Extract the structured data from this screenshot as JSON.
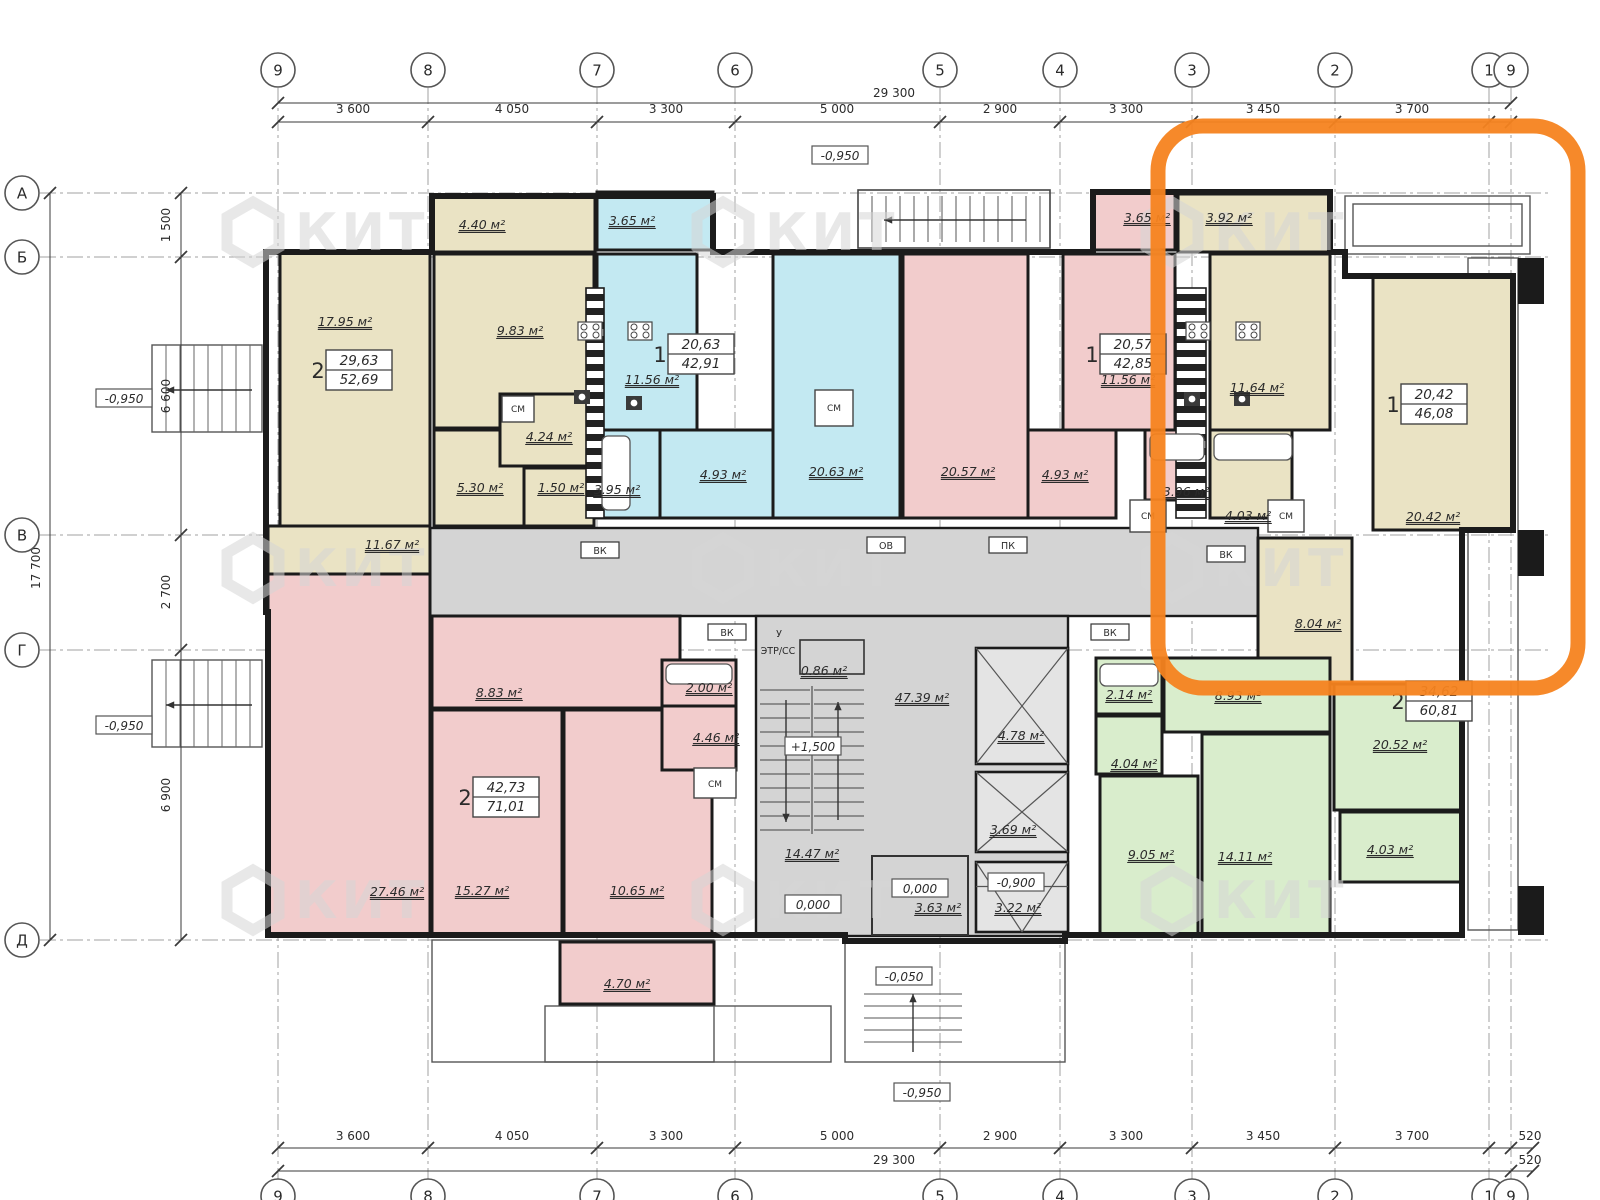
{
  "drawing": {
    "kind": "apartment-floor-plan",
    "watermark_text": "КИТ"
  },
  "colors": {
    "beige": "#EAE3C4",
    "cyan": "#C3E9F2",
    "pink": "#F2CCCC",
    "green": "#D9EDCC",
    "gray": "#D4D4D4",
    "lift": "#E4E4E4",
    "wall": "#1B1B1B",
    "dim": "#3A3A3A",
    "axis": "#A0A0A0",
    "orange": "#F5831F",
    "watermark": "#D6D6D6"
  },
  "highlight": {
    "x": 1158,
    "y": 126,
    "w": 420,
    "h": 562,
    "radius": 45,
    "stroke_width": 15
  },
  "watermark_positions": [
    [
      253,
      232
    ],
    [
      723,
      232
    ],
    [
      1172,
      232
    ],
    [
      253,
      568
    ],
    [
      723,
      568
    ],
    [
      1172,
      568
    ],
    [
      253,
      900
    ],
    [
      723,
      900
    ],
    [
      1172,
      900
    ]
  ],
  "axes": {
    "top_y": 70,
    "bottom_y": 1196,
    "left_x": 22,
    "vertical": [
      [
        "9",
        278
      ],
      [
        "8",
        428
      ],
      [
        "7",
        597
      ],
      [
        "6",
        735
      ],
      [
        "5",
        940
      ],
      [
        "4",
        1060
      ],
      [
        "3",
        1192
      ],
      [
        "2",
        1335
      ],
      [
        "1",
        1489
      ],
      [
        "9",
        1511
      ]
    ],
    "horizontal": [
      [
        "А",
        193
      ],
      [
        "Б",
        257
      ],
      [
        "В",
        535
      ],
      [
        "Г",
        650
      ],
      [
        "Д",
        940
      ]
    ]
  },
  "dimensions": {
    "top_total": {
      "text": "29 300",
      "x": 894,
      "y": 97,
      "line_y": 103
    },
    "top_segments": {
      "label_y": 113,
      "line_y": 122,
      "items": [
        [
          "3 600",
          353
        ],
        [
          "4 050",
          512
        ],
        [
          "3 300",
          666
        ],
        [
          "5 000",
          837
        ],
        [
          "2 900",
          1000
        ],
        [
          "3 300",
          1126
        ],
        [
          "3 450",
          1263
        ],
        [
          "3 700",
          1412
        ]
      ]
    },
    "bottom_segments": {
      "label_y": 1140,
      "line_y": 1148,
      "items": [
        [
          "3 600",
          353
        ],
        [
          "4 050",
          512
        ],
        [
          "3 300",
          666
        ],
        [
          "5 000",
          837
        ],
        [
          "2 900",
          1000
        ],
        [
          "3 300",
          1126
        ],
        [
          "3 450",
          1263
        ],
        [
          "3 700",
          1412
        ],
        [
          "520",
          1530
        ]
      ]
    },
    "bottom_total": {
      "text": "29 300",
      "x": 894,
      "y": 1164,
      "line_y": 1171,
      "extra_text": "520",
      "extra_x": 1530
    },
    "left_segments": {
      "label_x": 170,
      "line_x": 181,
      "items": [
        [
          "1 500",
          225
        ],
        [
          "6 600",
          396
        ],
        [
          "2 700",
          592
        ],
        [
          "6 900",
          795
        ]
      ]
    },
    "left_total": {
      "text": "17 700",
      "x": 40,
      "y": 568,
      "line_x": 50
    }
  },
  "apartments": [
    {
      "rooms_count": "2",
      "area_living": "29,63",
      "area_total": "52,69",
      "x": 348,
      "y": 370
    },
    {
      "rooms_count": "1",
      "area_living": "20,63",
      "area_total": "42,91",
      "x": 690,
      "y": 354
    },
    {
      "rooms_count": "1",
      "area_living": "20,57",
      "area_total": "42,85",
      "x": 1122,
      "y": 354
    },
    {
      "rooms_count": "1",
      "area_living": "20,42",
      "area_total": "46,08",
      "x": 1423,
      "y": 404
    },
    {
      "rooms_count": "2",
      "area_living": "42,73",
      "area_total": "71,01",
      "x": 495,
      "y": 797
    },
    {
      "rooms_count": "2",
      "area_living": "34,62",
      "area_total": "60,81",
      "x": 1428,
      "y": 701
    }
  ],
  "rooms": [
    {
      "name": "balcony",
      "area": "4.40 м²",
      "f": "beige",
      "r": [
        432,
        196,
        163,
        56
      ],
      "lx": 482,
      "ly": 229
    },
    {
      "name": "living",
      "area": "17.95 м²",
      "f": "beige",
      "r": [
        280,
        252,
        150,
        274
      ],
      "lx": 345,
      "ly": 326
    },
    {
      "name": "living",
      "area": "11.67 м²",
      "f": "beige",
      "r": [
        268,
        526,
        162,
        88
      ],
      "lx": 392,
      "ly": 549
    },
    {
      "name": "kitchen",
      "area": "9.83 м²",
      "f": "beige",
      "r": [
        434,
        254,
        160,
        174
      ],
      "lx": 520,
      "ly": 335
    },
    {
      "name": "hall",
      "area": "5.30 м²",
      "f": "beige",
      "r": [
        434,
        430,
        126,
        96
      ],
      "lx": 480,
      "ly": 492
    },
    {
      "name": "wc",
      "area": "4.24 м²",
      "f": "beige",
      "r": [
        500,
        394,
        94,
        72
      ],
      "lx": 549,
      "ly": 441
    },
    {
      "name": "wc",
      "area": "1.50 м²",
      "f": "beige",
      "r": [
        524,
        468,
        70,
        58
      ],
      "lx": 561,
      "ly": 492
    },
    {
      "name": "balcony",
      "area": "3.65 м²",
      "f": "cyan",
      "r": [
        597,
        192,
        116,
        58
      ],
      "lx": 632,
      "ly": 225
    },
    {
      "name": "kitchen",
      "area": "11.56 м²",
      "f": "cyan",
      "r": [
        597,
        254,
        100,
        176
      ],
      "lx": 652,
      "ly": 384
    },
    {
      "name": "living",
      "area": "20.63 м²",
      "f": "cyan",
      "r": [
        773,
        254,
        127,
        264
      ],
      "lx": 836,
      "ly": 476
    },
    {
      "name": "hall",
      "area": "4.93 м²",
      "f": "cyan",
      "r": [
        660,
        430,
        113,
        88
      ],
      "lx": 723,
      "ly": 479
    },
    {
      "name": "bath",
      "area": "3.95 м²",
      "f": "cyan",
      "r": [
        597,
        430,
        63,
        88
      ],
      "lx": 617,
      "ly": 494
    },
    {
      "name": "balcony",
      "area": "3.65 м²",
      "f": "pink",
      "r": [
        1093,
        192,
        82,
        58
      ],
      "lx": 1147,
      "ly": 222
    },
    {
      "name": "living",
      "area": "20.57 м²",
      "f": "pink",
      "r": [
        903,
        254,
        125,
        264
      ],
      "lx": 968,
      "ly": 476
    },
    {
      "name": "kitchen",
      "area": "11.56 м²",
      "f": "pink",
      "r": [
        1063,
        254,
        112,
        176
      ],
      "lx": 1128,
      "ly": 384
    },
    {
      "name": "hall",
      "area": "4.93 м²",
      "f": "pink",
      "r": [
        1028,
        430,
        88,
        88
      ],
      "lx": 1065,
      "ly": 479
    },
    {
      "name": "bath",
      "area": "3.96 м²",
      "f": "pink",
      "r": [
        1145,
        430,
        60,
        70
      ],
      "lx": 1186,
      "ly": 496
    },
    {
      "name": "balcony",
      "area": "3.92 м²",
      "f": "beige",
      "r": [
        1178,
        194,
        152,
        58
      ],
      "lx": 1229,
      "ly": 222
    },
    {
      "name": "kitchen",
      "area": "11.64 м²",
      "f": "beige",
      "r": [
        1210,
        254,
        120,
        176
      ],
      "lx": 1257,
      "ly": 392
    },
    {
      "name": "living",
      "area": "20.42 м²",
      "f": "beige",
      "r": [
        1373,
        276,
        140,
        254
      ],
      "lx": 1433,
      "ly": 521
    },
    {
      "name": "bath",
      "area": "4.03 м²",
      "f": "beige",
      "r": [
        1210,
        430,
        82,
        88
      ],
      "lx": 1248,
      "ly": 520
    },
    {
      "name": "hall",
      "area": "8.04 м²",
      "f": "beige",
      "r": [
        1258,
        538,
        94,
        146
      ],
      "lx": 1318,
      "ly": 628
    },
    {
      "name": "bath",
      "area": "2.14 м²",
      "f": "green",
      "r": [
        1096,
        658,
        66,
        56
      ],
      "lx": 1129,
      "ly": 699
    },
    {
      "name": "hall",
      "area": "8.93 м²",
      "f": "green",
      "r": [
        1164,
        658,
        166,
        74
      ],
      "lx": 1238,
      "ly": 700
    },
    {
      "name": "wc",
      "area": "4.04 м²",
      "f": "green",
      "r": [
        1096,
        716,
        66,
        58
      ],
      "lx": 1134,
      "ly": 768
    },
    {
      "name": "living",
      "area": "9.05 м²",
      "f": "green",
      "r": [
        1100,
        776,
        98,
        160
      ],
      "lx": 1151,
      "ly": 859
    },
    {
      "name": "living",
      "area": "14.11 м²",
      "f": "green",
      "r": [
        1202,
        734,
        128,
        202
      ],
      "lx": 1245,
      "ly": 861
    },
    {
      "name": "living",
      "area": "20.52 м²",
      "f": "green",
      "r": [
        1334,
        684,
        128,
        126
      ],
      "lx": 1400,
      "ly": 749
    },
    {
      "name": "balcony",
      "area": "4.03 м²",
      "f": "green",
      "r": [
        1340,
        812,
        122,
        70
      ],
      "lx": 1390,
      "ly": 854
    },
    {
      "name": "living",
      "area": "27.46 м²",
      "f": "pink",
      "r": [
        268,
        574,
        162,
        361
      ],
      "lx": 397,
      "ly": 896
    },
    {
      "name": "hall",
      "area": "8.83 м²",
      "f": "pink",
      "r": [
        432,
        616,
        248,
        92
      ],
      "lx": 499,
      "ly": 697
    },
    {
      "name": "living",
      "area": "15.27 м²",
      "f": "pink",
      "r": [
        432,
        710,
        130,
        226
      ],
      "lx": 482,
      "ly": 895
    },
    {
      "name": "kitchen",
      "area": "10.65 м²",
      "f": "pink",
      "r": [
        564,
        710,
        148,
        226
      ],
      "lx": 637,
      "ly": 895
    },
    {
      "name": "bath",
      "area": "2.00 м²",
      "f": "pink",
      "r": [
        662,
        660,
        74,
        46
      ],
      "lx": 709,
      "ly": 692
    },
    {
      "name": "wc",
      "area": "4.46 м²",
      "f": "pink",
      "r": [
        662,
        706,
        74,
        64
      ],
      "lx": 716,
      "ly": 742
    },
    {
      "name": "balcony",
      "area": "4.70 м²",
      "f": "pink",
      "r": [
        560,
        942,
        154,
        62
      ],
      "lx": 627,
      "ly": 988
    }
  ],
  "common_zones": {
    "corridor_band": [
      430,
      528,
      828,
      88
    ],
    "core_block": [
      756,
      616,
      312,
      320
    ],
    "vestibule": [
      800,
      640,
      64,
      34
    ],
    "room_363": [
      872,
      856,
      96,
      79
    ],
    "lifts": [
      {
        "area": "4.78 м²",
        "r": [
          976,
          648,
          92,
          116
        ],
        "lx": 1021,
        "ly": 740,
        "style": "x"
      },
      {
        "area": "3.69 м²",
        "r": [
          976,
          772,
          92,
          80
        ],
        "lx": 1013,
        "ly": 834,
        "style": "x"
      },
      {
        "area": "3.22 м²",
        "r": [
          976,
          862,
          92,
          70
        ],
        "lx": 1018,
        "ly": 912,
        "style": "funnel"
      }
    ],
    "area_labels": [
      [
        "47.39 м²",
        922,
        702
      ],
      [
        "14.47 м²",
        812,
        858
      ],
      [
        "0.86 м²",
        824,
        675
      ],
      [
        "3.63 м²",
        938,
        912
      ]
    ]
  },
  "closets": [
    {
      "label": "СМ",
      "r": [
        815,
        390,
        38,
        36
      ],
      "x": 834,
      "y": 411
    },
    {
      "label": "СМ",
      "r": [
        1130,
        500,
        36,
        32
      ],
      "x": 1148,
      "y": 519
    },
    {
      "label": "СМ",
      "r": [
        1268,
        500,
        36,
        32
      ],
      "x": 1286,
      "y": 519
    },
    {
      "label": "СМ",
      "r": [
        694,
        768,
        42,
        30
      ],
      "x": 715,
      "y": 787
    },
    {
      "label": "СМ",
      "r": [
        502,
        396,
        32,
        26
      ],
      "x": 518,
      "y": 412
    }
  ],
  "level_labels": [
    {
      "text": "-0,950",
      "x": 124,
      "y": 400
    },
    {
      "text": "-0,950",
      "x": 840,
      "y": 157
    },
    {
      "text": "-0,950",
      "x": 124,
      "y": 727
    },
    {
      "text": "+1,500",
      "x": 813,
      "y": 748
    },
    {
      "text": "0,000",
      "x": 813,
      "y": 906
    },
    {
      "text": "0,000",
      "x": 920,
      "y": 890
    },
    {
      "text": "-0,900",
      "x": 1016,
      "y": 884
    },
    {
      "text": "-0,050",
      "x": 904,
      "y": 978
    },
    {
      "text": "-0,950",
      "x": 922,
      "y": 1094
    }
  ],
  "tech_labels": [
    {
      "text": "ВК",
      "x": 600,
      "y": 551,
      "boxed": true
    },
    {
      "text": "ОВ",
      "x": 886,
      "y": 546,
      "boxed": true
    },
    {
      "text": "ПК",
      "x": 1008,
      "y": 546,
      "boxed": true
    },
    {
      "text": "ВК",
      "x": 727,
      "y": 633,
      "boxed": true
    },
    {
      "text": "ВК",
      "x": 1226,
      "y": 555,
      "boxed": true
    },
    {
      "text": "ВК",
      "x": 1110,
      "y": 633,
      "boxed": true
    },
    {
      "text": "У",
      "x": 779,
      "y": 634,
      "boxed": false
    },
    {
      "text": "ЭТР/СС",
      "x": 778,
      "y": 651,
      "boxed": false
    }
  ],
  "geometry": {
    "outline": "266,252 432,252 432,196 713,196 713,252 1093,252 1093,192 1330,192 1330,252 1345,252 1345,276 1513,276 1513,530 1462,530 1462,935 1065,935 1065,941 845,941 845,935 268,935 268,612 266,612",
    "striped_columns": [
      [
        586,
        288,
        18,
        230
      ],
      [
        1176,
        288,
        30,
        230
      ]
    ],
    "thin_rects": [
      [
        1345,
        196,
        185,
        58
      ],
      [
        1353,
        204,
        169,
        42
      ],
      [
        1468,
        258,
        50,
        672
      ],
      [
        432,
        940,
        282,
        122
      ],
      [
        545,
        1006,
        286,
        56
      ],
      [
        845,
        940,
        220,
        122
      ]
    ],
    "dark_blocks": [
      [
        1518,
        258,
        26,
        46
      ],
      [
        1518,
        530,
        26,
        46
      ],
      [
        1518,
        886,
        26,
        49
      ]
    ],
    "stoves": [
      [
        578,
        322
      ],
      [
        628,
        322
      ],
      [
        1186,
        322
      ],
      [
        1236,
        322
      ]
    ],
    "sinks": [
      [
        574,
        390
      ],
      [
        626,
        396
      ],
      [
        1184,
        392
      ],
      [
        1234,
        392
      ]
    ],
    "tubs": [
      [
        602,
        436,
        28,
        74
      ],
      [
        1150,
        434,
        54,
        26
      ],
      [
        1214,
        434,
        78,
        26
      ],
      [
        1100,
        664,
        58,
        22
      ],
      [
        666,
        664,
        66,
        20
      ]
    ]
  }
}
